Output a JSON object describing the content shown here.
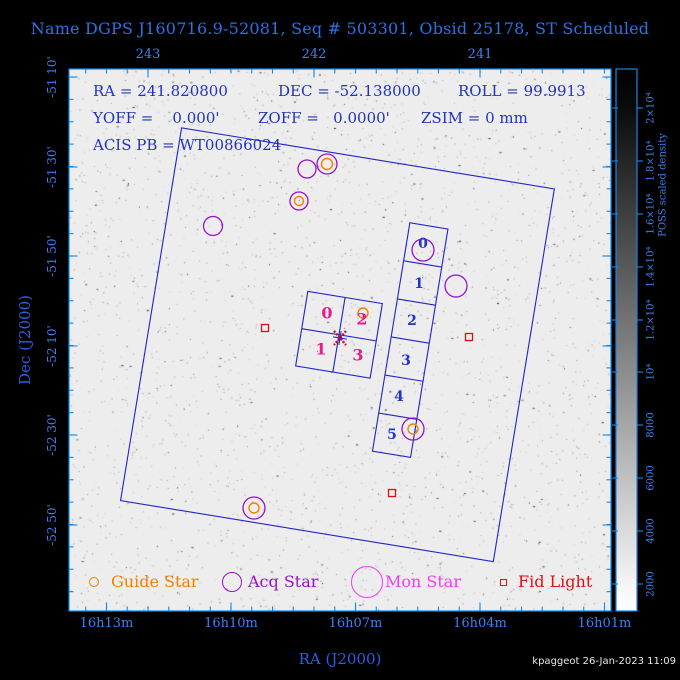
{
  "title": "Name DGPS J160716.9-52081, Seq # 503301, Obsid 25178, ST Scheduled",
  "credit": "kpaggeot 26-Jan-2023 11:09",
  "colors": {
    "frame": "#0b8bee",
    "tick_label": "#3c82f0",
    "title_blue": "#2a72e8",
    "axis_title": "#2a5fe8",
    "info_blue": "#2233bb",
    "detector_blue": "#2222cc",
    "chip_i_pink": "#e81a8c",
    "chip_s_blue": "#2233cc",
    "guide_orange": "#f58000",
    "acq_purple": "#9812c8",
    "mon_magenta": "#f03cf0",
    "fid_red": "#e01010",
    "aim_red": "#c81616",
    "plot_bg": "#ededed"
  },
  "info": {
    "l1a": "RA = 241.820800",
    "l1b": "DEC = -52.138000",
    "l1c": "ROLL = 99.9913",
    "l2a": "YOFF =    0.000'",
    "l2b": "ZOFF =   0.0000'",
    "l2c": "ZSIM = 0 mm",
    "l3": "ACIS PB = WT00866024"
  },
  "axes": {
    "top": {
      "ticks": [
        {
          "label": "243",
          "x": 148
        },
        {
          "label": "242",
          "x": 314
        },
        {
          "label": "241",
          "x": 480
        }
      ],
      "minor_anchor": 148,
      "minor_step": 20.75,
      "minor_kmin": -3,
      "minor_kmax": 22
    },
    "bottom": {
      "title": "RA (J2000)",
      "ticks": [
        {
          "label": "16h13m",
          "x": 106.5
        },
        {
          "label": "16h10m",
          "x": 231
        },
        {
          "label": "16h07m",
          "x": 355.5
        },
        {
          "label": "16h04m",
          "x": 480
        },
        {
          "label": "16h01m",
          "x": 604.5
        }
      ],
      "minor_anchor": 106.5,
      "minor_step": 20.75,
      "minor_kmin": -1,
      "minor_kmax": 24
    },
    "left": {
      "title": "Dec (J2000)",
      "ticks": [
        {
          "label": "-51 10'",
          "y": 77
        },
        {
          "label": "-51 30'",
          "y": 167
        },
        {
          "label": "-51 50'",
          "y": 256
        },
        {
          "label": "-52 10'",
          "y": 346
        },
        {
          "label": "-52 30'",
          "y": 435
        },
        {
          "label": "-52 50'",
          "y": 525
        }
      ],
      "minor_anchor": 77,
      "minor_step": 22.375,
      "minor_kmin": 0,
      "minor_kmax": 23
    }
  },
  "colorbar": {
    "title": "POSS scaled density",
    "ticks": [
      {
        "label": "2000",
        "y": 584
      },
      {
        "label": "4000",
        "y": 531
      },
      {
        "label": "6000",
        "y": 478
      },
      {
        "label": "8000",
        "y": 425
      },
      {
        "label": "10⁴",
        "y": 372
      },
      {
        "label": "1.2×10⁴",
        "y": 320
      },
      {
        "label": "1.4×10⁴",
        "y": 267
      },
      {
        "label": "1.6×10⁴",
        "y": 214
      },
      {
        "label": "1.8×10⁴",
        "y": 161
      },
      {
        "label": "2×10⁴",
        "y": 108
      }
    ]
  },
  "detectors": {
    "rotation_deg": 9.3,
    "pivot_x": 337.5,
    "pivot_y": 344.75,
    "fov": {
      "x": 148.6,
      "y": 155.9,
      "w": 377.7,
      "h": 377.7
    },
    "acis_i": {
      "x": 299.6,
      "y": 296.9,
      "w": 75.5,
      "h": 75.5,
      "chip_labels": [
        {
          "label": "0",
          "x": 327,
          "y": 313
        },
        {
          "label": "2",
          "x": 362,
          "y": 319
        },
        {
          "label": "1",
          "x": 321,
          "y": 349
        },
        {
          "label": "3",
          "x": 358,
          "y": 355
        }
      ]
    },
    "acis_s": {
      "x": 389.2,
      "y": 212.7,
      "w": 38.6,
      "h": 231.4,
      "n_chips": 6,
      "chip_labels": [
        {
          "label": "0",
          "x": 423,
          "y": 244
        },
        {
          "label": "1",
          "x": 419,
          "y": 284
        },
        {
          "label": "2",
          "x": 412,
          "y": 321
        },
        {
          "label": "3",
          "x": 406,
          "y": 361
        },
        {
          "label": "4",
          "x": 399,
          "y": 397
        },
        {
          "label": "5",
          "x": 392,
          "y": 435
        }
      ]
    }
  },
  "symbols": {
    "guide_stars": [
      {
        "x": 327,
        "y": 164,
        "r": 5.5,
        "ring": 10
      },
      {
        "x": 299,
        "y": 201,
        "r": 4.5,
        "ring": 9
      },
      {
        "x": 363,
        "y": 313,
        "r": 5,
        "ring": 0
      },
      {
        "x": 413,
        "y": 429,
        "r": 5,
        "ring": 11
      },
      {
        "x": 254,
        "y": 508,
        "r": 5,
        "ring": 11
      }
    ],
    "acq_stars": [
      {
        "x": 307,
        "y": 169,
        "r": 9
      },
      {
        "x": 213,
        "y": 226,
        "r": 9.5
      },
      {
        "x": 423,
        "y": 250,
        "r": 11
      },
      {
        "x": 456,
        "y": 286,
        "r": 11
      }
    ],
    "fid_lights": [
      {
        "x": 265,
        "y": 328,
        "s": 7
      },
      {
        "x": 469,
        "y": 337,
        "s": 7
      },
      {
        "x": 392,
        "y": 493,
        "s": 7
      }
    ],
    "aimpoint": {
      "x": 340,
      "y": 338
    }
  },
  "legend": {
    "y": 582,
    "items": [
      {
        "label": "Guide Star",
        "shape": "circle",
        "r": 5,
        "color": "#f58000",
        "shape_x": 94,
        "text_x": 111
      },
      {
        "label": "Acq Star",
        "shape": "circle",
        "r": 10,
        "color": "#9812c8",
        "shape_x": 232,
        "text_x": 248
      },
      {
        "label": "Mon Star",
        "shape": "circle",
        "r": 16,
        "color": "#f03cf0",
        "shape_x": 367,
        "text_x": 385
      },
      {
        "label": "Fid Light",
        "shape": "square",
        "r": 3.5,
        "color": "#e01010",
        "shape_x": 503,
        "text_x": 518
      }
    ]
  },
  "chart_data": {
    "type": "scatter",
    "title": "Chandra observation field-of-view plot over POSS sky image",
    "target": {
      "name": "DGPS J160716.9-52081",
      "seq": "503301",
      "obsid": "25178",
      "status": "ST Scheduled",
      "ra_deg": 241.8208,
      "dec_deg": -52.138,
      "roll_deg": 99.9913,
      "yoff_arcmin": 0.0,
      "zoff_arcmin": 0.0,
      "zsim_mm": 0
    },
    "xlabel": "RA (J2000)",
    "ylabel": "Dec (J2000)",
    "x_range_ra_deg": [
      243.48,
      240.21
    ],
    "y_range_dec_deg": [
      -51.14,
      -53.16
    ],
    "colorbar_range": [
      2000,
      20000
    ],
    "series": [
      {
        "name": "Guide Star",
        "points_radec": [
          [
            241.92,
            -51.49
          ],
          [
            242.09,
            -51.63
          ],
          [
            241.71,
            -52.05
          ],
          [
            241.4,
            -52.48
          ],
          [
            242.36,
            -52.77
          ]
        ]
      },
      {
        "name": "Acq Star",
        "points_radec": [
          [
            242.04,
            -51.51
          ],
          [
            242.61,
            -51.72
          ],
          [
            241.34,
            -51.81
          ],
          [
            241.15,
            -51.95
          ]
        ]
      },
      {
        "name": "Fid Light",
        "points_radec": [
          [
            242.3,
            -52.1
          ],
          [
            241.07,
            -52.14
          ],
          [
            241.53,
            -52.72
          ]
        ]
      },
      {
        "name": "Aimpoint",
        "points_radec": [
          [
            241.82,
            -52.14
          ]
        ]
      }
    ],
    "detector_chips": {
      "ACIS-I": [
        "0",
        "1",
        "2",
        "3"
      ],
      "ACIS-S": [
        "0",
        "1",
        "2",
        "3",
        "4",
        "5"
      ]
    }
  }
}
